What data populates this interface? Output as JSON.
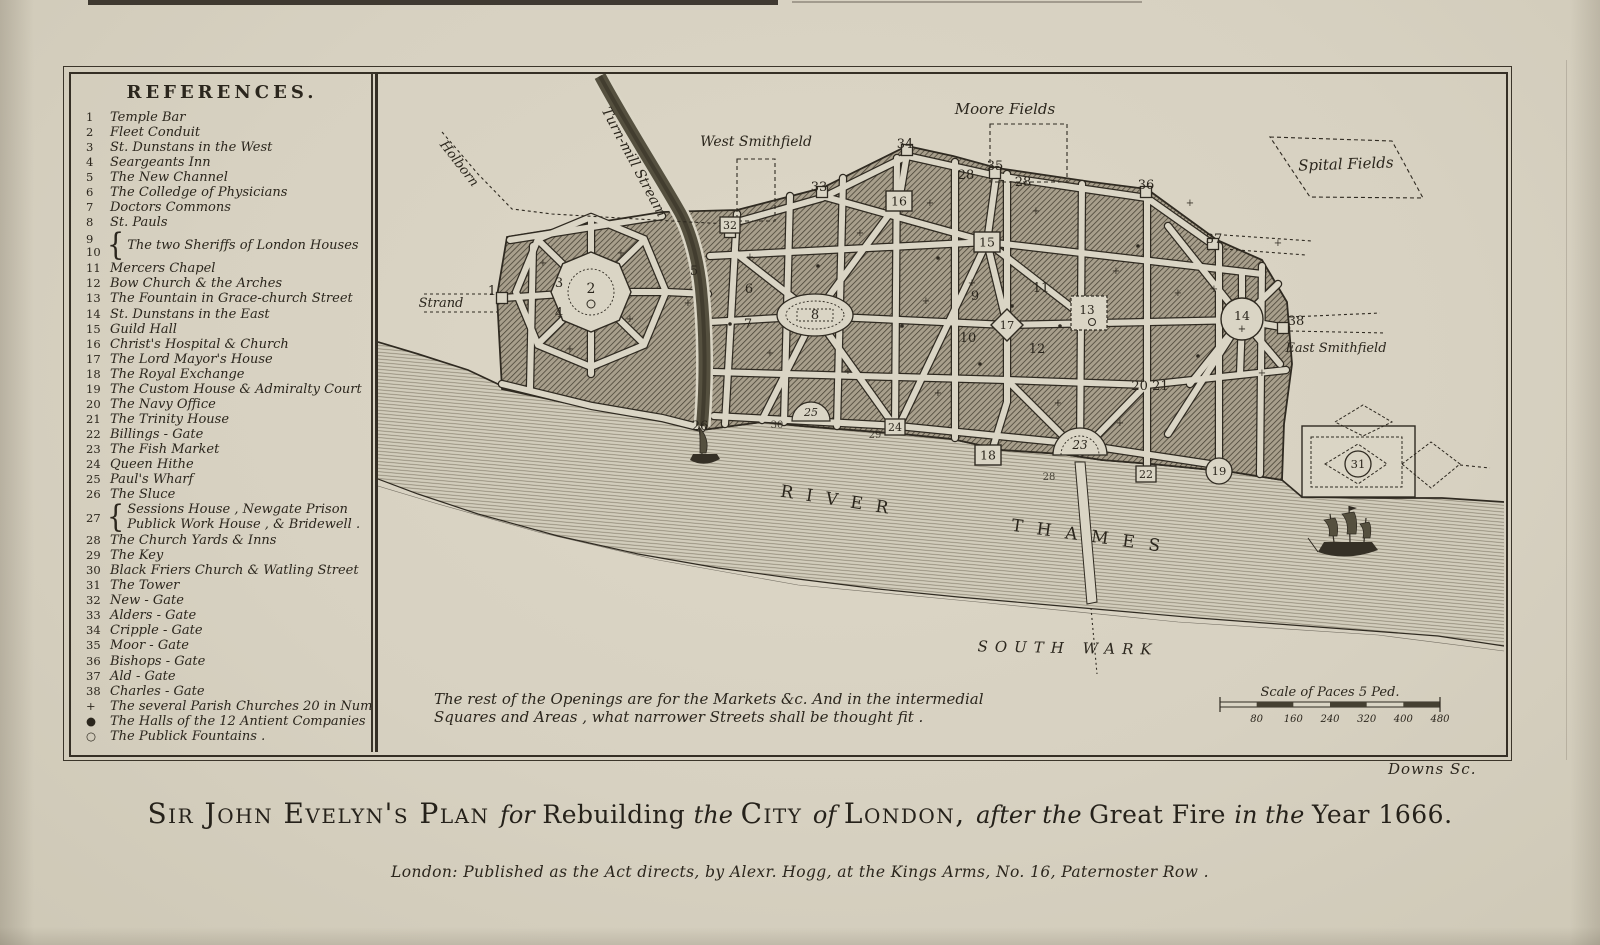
{
  "page": {
    "signature": "Downs Sc.",
    "imprint": "London: Published as the Act directs, by Alexr. Hogg, at the Kings Arms, No. 16, Paternoster Row .",
    "title_segments": [
      {
        "t": "Sir John Evelyn's Plan ",
        "s": "sc"
      },
      {
        "t": "for ",
        "s": "it"
      },
      {
        "t": "Rebuilding ",
        "s": "rm"
      },
      {
        "t": "the ",
        "s": "it"
      },
      {
        "t": "City ",
        "s": "sc"
      },
      {
        "t": "of ",
        "s": "it"
      },
      {
        "t": "London, ",
        "s": "sc"
      },
      {
        "t": "after the ",
        "s": "it"
      },
      {
        "t": "Great Fire ",
        "s": "rm"
      },
      {
        "t": "in the ",
        "s": "it"
      },
      {
        "t": "Year 1666.",
        "s": "rm"
      }
    ]
  },
  "references": {
    "title": "REFERENCES.",
    "items": [
      {
        "n": "1",
        "label": "Temple Bar"
      },
      {
        "n": "2",
        "label": "Fleet Conduit"
      },
      {
        "n": "3",
        "label": "St. Dunstans in the West"
      },
      {
        "n": "4",
        "label": "Seargeants Inn"
      },
      {
        "n": "5",
        "label": "The New Channel"
      },
      {
        "n": "6",
        "label": "The Colledge of Physicians"
      },
      {
        "n": "7",
        "label": "Doctors Commons"
      },
      {
        "n": "8",
        "label": "St. Pauls"
      },
      {
        "n": "9",
        "n2": "10",
        "type": "dual",
        "label": "The two Sheriffs of London Houses"
      },
      {
        "n": "11",
        "label": "Mercers Chapel"
      },
      {
        "n": "12",
        "label": "Bow Church & the Arches"
      },
      {
        "n": "13",
        "label": "The Fountain in Grace-church Street"
      },
      {
        "n": "14",
        "label": "St. Dunstans in the East"
      },
      {
        "n": "15",
        "label": "Guild Hall"
      },
      {
        "n": "16",
        "label": "Christ's Hospital & Church"
      },
      {
        "n": "17",
        "label": "The Lord Mayor's House"
      },
      {
        "n": "18",
        "label": "The Royal Exchange"
      },
      {
        "n": "19",
        "label": "The Custom House & Admiralty Court"
      },
      {
        "n": "20",
        "label": "The Navy Office"
      },
      {
        "n": "21",
        "label": "The Trinity House"
      },
      {
        "n": "22",
        "label": "Billings - Gate"
      },
      {
        "n": "23",
        "label": "The Fish Market"
      },
      {
        "n": "24",
        "label": "Queen Hithe"
      },
      {
        "n": "25",
        "label": "Paul's Wharf"
      },
      {
        "n": "26",
        "label": "The Sluce"
      },
      {
        "n": "27",
        "type": "stack",
        "label": "Sessions House , Newgate Prison",
        "label2": "Publick Work House , & Bridewell ."
      },
      {
        "n": "28",
        "label": "The Church Yards & Inns"
      },
      {
        "n": "29",
        "label": "The Key"
      },
      {
        "n": "30",
        "label": "Black Friers Church & Watling Street"
      },
      {
        "n": "31",
        "label": "The Tower"
      },
      {
        "n": "32",
        "label": "New - Gate"
      },
      {
        "n": "33",
        "label": "Alders - Gate"
      },
      {
        "n": "34",
        "label": "Cripple - Gate"
      },
      {
        "n": "35",
        "label": "Moor - Gate"
      },
      {
        "n": "36",
        "label": "Bishops - Gate"
      },
      {
        "n": "37",
        "label": "Ald - Gate"
      },
      {
        "n": "38",
        "label": "Charles - Gate"
      },
      {
        "n": "+",
        "type": "sym",
        "label": "The several Parish Churches 20 in Number."
      },
      {
        "n": "●",
        "type": "sym",
        "label": "The Halls of the 12 Antient Companies ."
      },
      {
        "n": "○",
        "type": "sym",
        "label": "The Publick Fountains ."
      }
    ]
  },
  "map": {
    "labels": [
      {
        "id": "holborn",
        "text": "Holborn",
        "x": 78,
        "y": 92,
        "rot": 52,
        "size": 13,
        "italic": true
      },
      {
        "id": "turnmill-stream",
        "text": "Turn-mill Stream",
        "x": 252,
        "y": 90,
        "rot": 62,
        "size": 14,
        "italic": true
      },
      {
        "id": "west-smithfield",
        "text": "West Smithfield",
        "x": 378,
        "y": 72,
        "rot": 0,
        "size": 14,
        "italic": true
      },
      {
        "id": "moore-fields",
        "text": "Moore Fields",
        "x": 627,
        "y": 40,
        "rot": 0,
        "size": 15,
        "italic": true
      },
      {
        "id": "spital-fields",
        "text": "Spital Fields",
        "x": 968,
        "y": 95,
        "rot": -2,
        "size": 15,
        "italic": true
      },
      {
        "id": "strand",
        "text": "Strand",
        "x": 63,
        "y": 233,
        "rot": 0,
        "size": 13,
        "italic": true
      },
      {
        "id": "east-smithfield",
        "text": "East Smithfield",
        "x": 958,
        "y": 278,
        "rot": 0,
        "size": 13,
        "italic": true
      },
      {
        "id": "river",
        "text": "RIVER",
        "x": 462,
        "y": 432,
        "rot": 9,
        "size": 17,
        "spacing": 13,
        "italic": false
      },
      {
        "id": "thames",
        "text": "THAMES",
        "x": 714,
        "y": 468,
        "rot": 8,
        "size": 17,
        "spacing": 14,
        "italic": false
      },
      {
        "id": "southwark",
        "text": "SOUTH  WARK",
        "x": 690,
        "y": 579,
        "rot": 1,
        "size": 15,
        "spacing": 7,
        "italic": true
      }
    ],
    "note": {
      "line1": "The rest of the Openings are for the Markets &c. And in the intermedial",
      "line2": "Squares and Areas , what narrower Streets shall be thought fit ."
    },
    "scale": {
      "caption": "Scale of Paces 5 Ped.",
      "ticks": [
        "80",
        "160",
        "240",
        "320",
        "400",
        "480"
      ]
    },
    "markers": [
      {
        "n": "1",
        "shape": "num",
        "x": 114,
        "y": 217
      },
      {
        "n": "2",
        "shape": "octagon",
        "x": 213,
        "y": 218
      },
      {
        "n": "3",
        "shape": "num",
        "x": 181,
        "y": 209
      },
      {
        "n": "4",
        "shape": "num",
        "x": 181,
        "y": 239
      },
      {
        "n": "5",
        "shape": "num",
        "x": 316,
        "y": 197
      },
      {
        "n": "6",
        "shape": "num",
        "x": 371,
        "y": 215
      },
      {
        "n": "7",
        "shape": "num",
        "x": 370,
        "y": 250
      },
      {
        "n": "8",
        "shape": "oval",
        "x": 437,
        "y": 241
      },
      {
        "n": "9",
        "shape": "num",
        "x": 597,
        "y": 222
      },
      {
        "n": "10",
        "shape": "num",
        "x": 590,
        "y": 264
      },
      {
        "n": "11",
        "shape": "num",
        "x": 663,
        "y": 214
      },
      {
        "n": "12",
        "shape": "num",
        "x": 659,
        "y": 275
      },
      {
        "n": "13",
        "shape": "dotsq",
        "x": 711,
        "y": 239
      },
      {
        "n": "14",
        "shape": "circle-plaza",
        "x": 864,
        "y": 245
      },
      {
        "n": "15",
        "shape": "sq",
        "x": 609,
        "y": 168
      },
      {
        "n": "16",
        "shape": "sq",
        "x": 521,
        "y": 127
      },
      {
        "n": "17",
        "shape": "diamond",
        "x": 629,
        "y": 251
      },
      {
        "n": "18",
        "shape": "sq",
        "x": 610,
        "y": 381
      },
      {
        "n": "19",
        "shape": "circle",
        "x": 841,
        "y": 397
      },
      {
        "n": "20 21",
        "shape": "num",
        "x": 772,
        "y": 312
      },
      {
        "n": "22",
        "shape": "sq-sm",
        "x": 768,
        "y": 400
      },
      {
        "n": "23",
        "shape": "semi",
        "x": 702,
        "y": 381
      },
      {
        "n": "24",
        "shape": "sq-sm",
        "x": 517,
        "y": 353
      },
      {
        "n": "25",
        "shape": "semi-sm",
        "x": 433,
        "y": 347
      },
      {
        "n": "26",
        "shape": "num",
        "x": 322,
        "y": 352
      },
      {
        "n": "28",
        "shape": "num",
        "x": 588,
        "y": 101
      },
      {
        "n": "28",
        "shape": "num",
        "x": 645,
        "y": 108
      },
      {
        "n": "30",
        "shape": "num-sm",
        "x": 399,
        "y": 351
      },
      {
        "n": "29",
        "shape": "num-sm",
        "x": 497,
        "y": 361
      },
      {
        "n": "28",
        "shape": "num-sm",
        "x": 671,
        "y": 403
      },
      {
        "n": "31",
        "shape": "circle",
        "x": 980,
        "y": 390
      },
      {
        "n": "32",
        "shape": "sq-sm",
        "x": 352,
        "y": 151
      },
      {
        "n": "33",
        "shape": "num",
        "x": 441,
        "y": 113
      },
      {
        "n": "34",
        "shape": "num",
        "x": 527,
        "y": 70
      },
      {
        "n": "35",
        "shape": "num",
        "x": 617,
        "y": 92
      },
      {
        "n": "36",
        "shape": "num",
        "x": 768,
        "y": 111
      },
      {
        "n": "37",
        "shape": "num",
        "x": 836,
        "y": 165
      },
      {
        "n": "38",
        "shape": "num",
        "x": 918,
        "y": 247
      }
    ]
  }
}
